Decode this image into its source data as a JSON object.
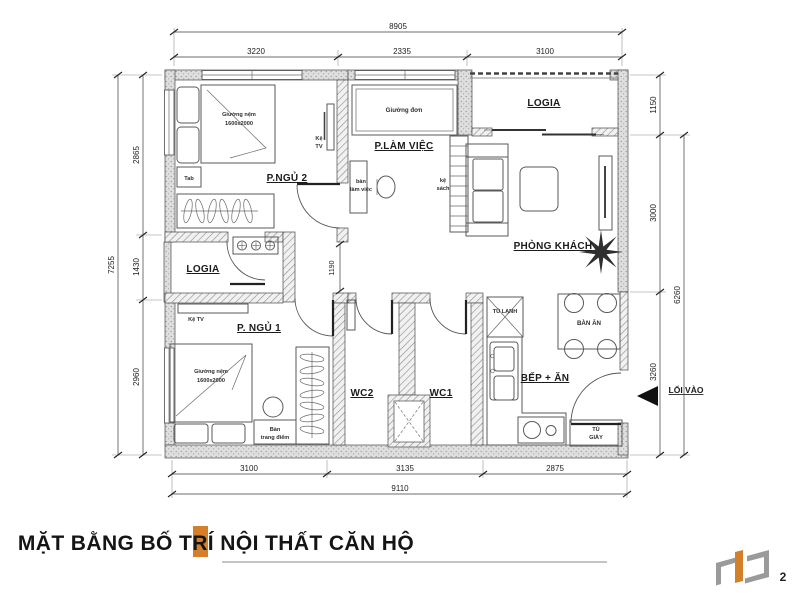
{
  "title": {
    "text": "MẶT BẰNG BỐ TRÍ NỘI THẤT CĂN HỘ",
    "page_number": "2"
  },
  "colors": {
    "accent": "#D4802B",
    "logo_gray": "#9a9a9c"
  },
  "dims": {
    "top_total": "8905",
    "top_segments": [
      "3220",
      "2335",
      "3100"
    ],
    "bottom_segments": [
      "3100",
      "3135",
      "2875"
    ],
    "bottom_total": "9110",
    "left_total": "7255",
    "left_segments": [
      "2865",
      "1430",
      "2960"
    ],
    "right_segments": [
      "1150",
      "3000",
      "3260"
    ],
    "right_total": "6260",
    "corridor": "1190"
  },
  "labels": {
    "bedroom2": "P.NGỦ 2",
    "bedroom1": "P. NGỦ 1",
    "work_room": "P.LÀM VIỆC",
    "living_room": "PHÒNG KHÁCH",
    "logia_top": "LOGIA",
    "logia_left": "LOGIA",
    "kitchen": "BẾP + ĂN",
    "wc1": "WC1",
    "wc2": "WC2",
    "entrance": "LỐI VÀO",
    "bed_double_line1": "Giường nệm",
    "bed_double_line2": "1600x2000",
    "bed_single": "Giường đơn",
    "tab": "Tab",
    "tv_shelf_line1": "Kệ",
    "tv_shelf_line2": "TV",
    "tv_shelf_bedroom1": "Kệ TV",
    "desk_line1": "bàn",
    "desk_line2": "làm việc",
    "bookshelf_line1": "kệ",
    "bookshelf_line2": "sách",
    "dressing_line1": "Bàn",
    "dressing_line2": "trang điểm",
    "fridge": "TỦ LẠNH",
    "dining_table": "BÀN ĂN",
    "shoe_cabinet_line1": "TỦ",
    "shoe_cabinet_line2": "GIÀY"
  }
}
